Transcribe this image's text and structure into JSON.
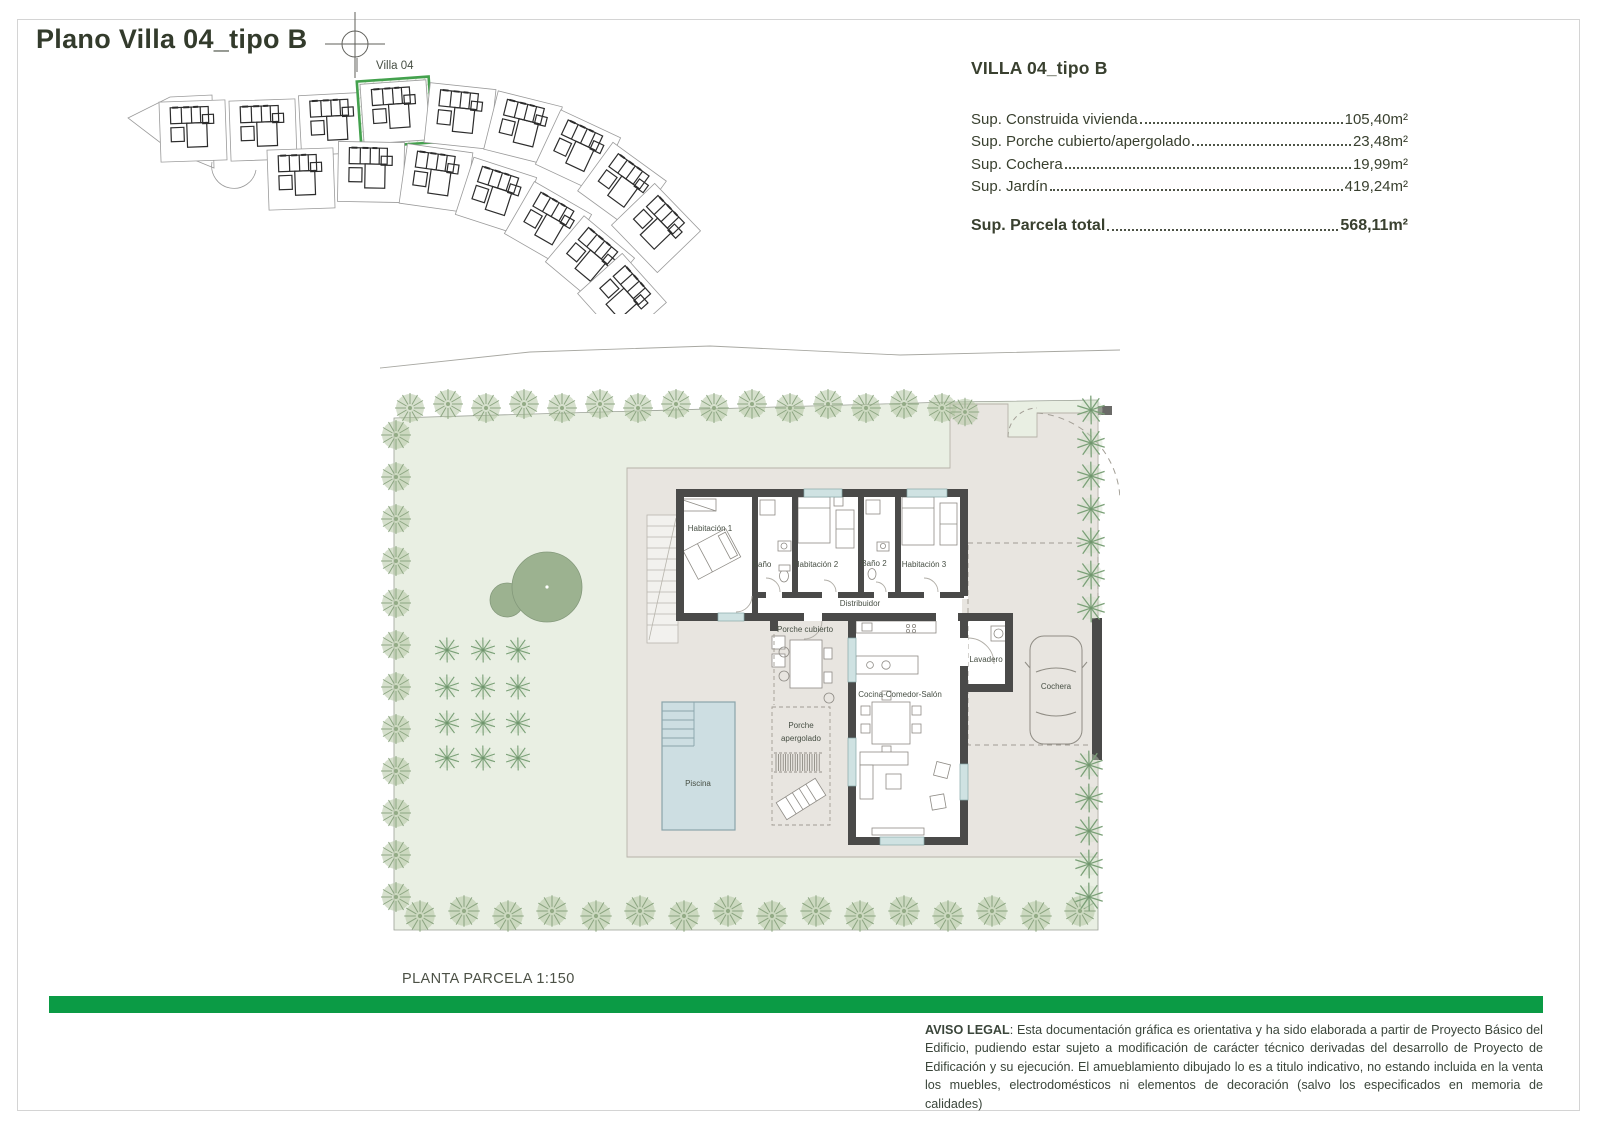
{
  "page": {
    "title": "Plano Villa 04_tipo B",
    "site_label": "Villa 04",
    "scale_label": "PLANTA PARCELA 1:150"
  },
  "info_panel": {
    "heading": "VILLA 04_tipo B",
    "rows": [
      {
        "label": "Sup. Construida vivienda",
        "value": "105,40m²"
      },
      {
        "label": "Sup. Porche cubierto/apergolado",
        "value": "23,48m²"
      },
      {
        "label": "Sup. Cochera",
        "value": "19,99m²"
      },
      {
        "label": "Sup. Jardín",
        "value": "419,24m²"
      }
    ],
    "total": {
      "label": "Sup. Parcela total",
      "value": "568,11m²"
    }
  },
  "floor_plan": {
    "rooms": [
      {
        "id": "habitacion1",
        "label": "Habitación 1"
      },
      {
        "id": "bano1",
        "label": "Baño"
      },
      {
        "id": "habitacion2",
        "label": "Habitación 2"
      },
      {
        "id": "bano2",
        "label": "Baño 2"
      },
      {
        "id": "habitacion3",
        "label": "Habitación 3"
      },
      {
        "id": "distribuidor",
        "label": "Distribuidor"
      },
      {
        "id": "porche_cubierto",
        "label": "Porche cubierto"
      },
      {
        "id": "porche_apergolado",
        "label": "Porche apergolado",
        "line1": "Porche",
        "line2": "apergolado"
      },
      {
        "id": "cocina_comedor_salon",
        "label": "Cocina-Comedor-Salón"
      },
      {
        "id": "lavadero",
        "label": "Lavadero"
      },
      {
        "id": "cochera",
        "label": "Cochera"
      },
      {
        "id": "piscina",
        "label": "Piscina"
      }
    ]
  },
  "legal": {
    "label": "AVISO LEGAL",
    "text": ": Esta documentación gráfica es orientativa y ha sido elaborada a partir de Proyecto Básico del Edificio, pudiendo estar sujeto a modificación de carácter técnico derivadas del desarrollo de Proyecto de Edificación y su ejecución. El amueblamiento dibujado lo es a titulo indicativo, no estando incluida en la venta los muebles, electrodomésticos ni elementos de decoración (salvo los especificados en memoria de calidades)"
  },
  "colors": {
    "accent_green_bar": "#0b9b45",
    "highlight_green": "#43a14d",
    "title_text": "#333b2c",
    "wall": "#4a4a49",
    "terrace": "#e8e5e0",
    "garden": "#e9efe3",
    "pool": "#cddee2",
    "tree_green": "#8da682"
  }
}
